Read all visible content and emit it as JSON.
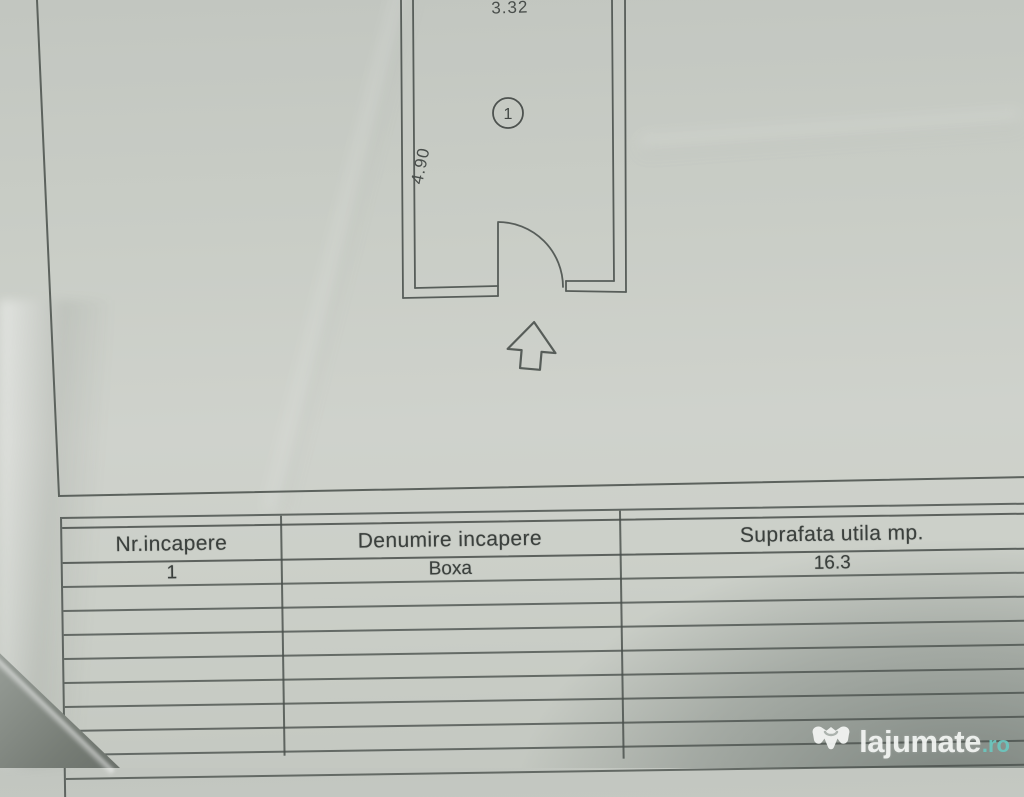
{
  "plan": {
    "dim_top": "3.32",
    "dim_left": "4.90",
    "room_number": "1"
  },
  "table": {
    "headers": [
      "Nr.incapere",
      "Denumire incapere",
      "Suprafata utila mp."
    ],
    "rows": [
      [
        "1",
        "Boxa",
        "16.3"
      ]
    ],
    "empty_row_count": 8
  },
  "watermark": {
    "brand": "lajumate",
    "tld": ".ro",
    "brand_color": "#f3f5f3",
    "tld_color": "#6cc6be"
  },
  "colors": {
    "paper": "#c9cdc6",
    "ink_lines": "#575d59",
    "ink_text": "#3b403d",
    "desk_surface": "#767c75"
  }
}
